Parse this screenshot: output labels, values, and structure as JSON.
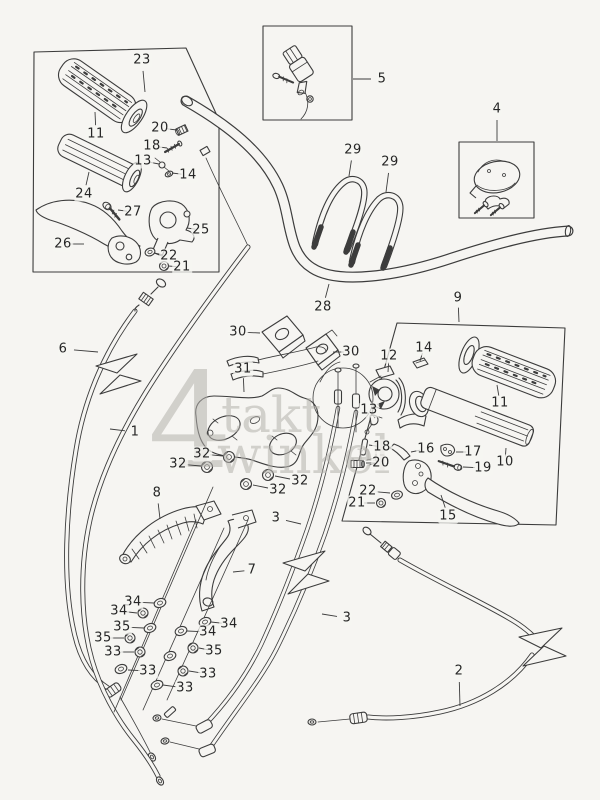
{
  "figure": {
    "background": "#f6f5f2",
    "line_color": "#3c3c3c",
    "label_color": "#262626"
  },
  "watermark": {
    "big": "4",
    "word1": "takt",
    "word2": "winkel",
    "suffix": ".nl",
    "color": "#b4b2ad"
  },
  "callouts": [
    {
      "label": "23",
      "x": 142,
      "y": 60,
      "tx": 145,
      "ty": 92
    },
    {
      "label": "11",
      "x": 96,
      "y": 134,
      "tx": 95,
      "ty": 112
    },
    {
      "label": "20",
      "x": 160,
      "y": 128,
      "tx": 177,
      "ty": 130
    },
    {
      "label": "18",
      "x": 152,
      "y": 146,
      "tx": 167,
      "ty": 148
    },
    {
      "label": "13",
      "x": 143,
      "y": 161,
      "tx": 159,
      "ty": 164
    },
    {
      "label": "14",
      "x": 188,
      "y": 175,
      "tx": 172,
      "ty": 173
    },
    {
      "label": "24",
      "x": 84,
      "y": 194,
      "tx": 89,
      "ty": 172
    },
    {
      "label": "27",
      "x": 133,
      "y": 212,
      "tx": 118,
      "ty": 210
    },
    {
      "label": "26",
      "x": 63,
      "y": 244,
      "tx": 84,
      "ty": 244
    },
    {
      "label": "25",
      "x": 201,
      "y": 230,
      "tx": 187,
      "ty": 228
    },
    {
      "label": "22",
      "x": 169,
      "y": 256,
      "tx": 154,
      "ty": 253
    },
    {
      "label": "21",
      "x": 182,
      "y": 267,
      "tx": 168,
      "ty": 266
    },
    {
      "label": "5",
      "x": 382,
      "y": 79,
      "tx": 353,
      "ty": 79
    },
    {
      "label": "4",
      "x": 497,
      "y": 109,
      "tx": 497,
      "ty": 141
    },
    {
      "label": "29",
      "x": 353,
      "y": 150,
      "tx": 349,
      "ty": 176
    },
    {
      "label": "29",
      "x": 390,
      "y": 162,
      "tx": 386,
      "ty": 192
    },
    {
      "label": "28",
      "x": 323,
      "y": 307,
      "tx": 329,
      "ty": 284
    },
    {
      "label": "9",
      "x": 458,
      "y": 298,
      "tx": 459,
      "ty": 322
    },
    {
      "label": "6",
      "x": 63,
      "y": 349,
      "tx": 98,
      "ty": 352
    },
    {
      "label": "1",
      "x": 135,
      "y": 432,
      "tx": 110,
      "ty": 429
    },
    {
      "label": "30",
      "x": 238,
      "y": 332,
      "tx": 260,
      "ty": 333
    },
    {
      "label": "30",
      "x": 351,
      "y": 352,
      "tx": 333,
      "ty": 352
    },
    {
      "label": "31",
      "x": 243,
      "y": 369,
      "tx": 244,
      "ty": 392
    },
    {
      "label": "12",
      "x": 389,
      "y": 356,
      "tx": 388,
      "ty": 372
    },
    {
      "label": "14",
      "x": 424,
      "y": 348,
      "tx": 420,
      "ty": 361
    },
    {
      "label": "13",
      "x": 369,
      "y": 410,
      "tx": 375,
      "ty": 418
    },
    {
      "label": "11",
      "x": 500,
      "y": 403,
      "tx": 497,
      "ty": 385
    },
    {
      "label": "10",
      "x": 505,
      "y": 462,
      "tx": 506,
      "ty": 448
    },
    {
      "label": "16",
      "x": 426,
      "y": 449,
      "tx": 411,
      "ty": 452
    },
    {
      "label": "17",
      "x": 473,
      "y": 452,
      "tx": 456,
      "ty": 452
    },
    {
      "label": "19",
      "x": 483,
      "y": 468,
      "tx": 463,
      "ty": 467
    },
    {
      "label": "18",
      "x": 382,
      "y": 447,
      "tx": 369,
      "ty": 445
    },
    {
      "label": "20",
      "x": 381,
      "y": 463,
      "tx": 366,
      "ty": 463
    },
    {
      "label": "22",
      "x": 368,
      "y": 491,
      "tx": 390,
      "ty": 493
    },
    {
      "label": "21",
      "x": 357,
      "y": 503,
      "tx": 375,
      "ty": 503
    },
    {
      "label": "15",
      "x": 448,
      "y": 516,
      "tx": 441,
      "ty": 495
    },
    {
      "label": "32",
      "x": 202,
      "y": 454,
      "tx": 223,
      "ty": 456
    },
    {
      "label": "32",
      "x": 178,
      "y": 464,
      "tx": 201,
      "ty": 466
    },
    {
      "label": "32",
      "x": 300,
      "y": 481,
      "tx": 275,
      "ty": 476
    },
    {
      "label": "32",
      "x": 278,
      "y": 490,
      "tx": 253,
      "ty": 485
    },
    {
      "label": "8",
      "x": 157,
      "y": 493,
      "tx": 160,
      "ty": 519
    },
    {
      "label": "7",
      "x": 252,
      "y": 570,
      "tx": 233,
      "ty": 572
    },
    {
      "label": "3",
      "x": 276,
      "y": 518,
      "tx": 301,
      "ty": 524
    },
    {
      "label": "3",
      "x": 347,
      "y": 618,
      "tx": 322,
      "ty": 614
    },
    {
      "label": "34",
      "x": 133,
      "y": 602,
      "tx": 154,
      "ty": 603
    },
    {
      "label": "34",
      "x": 119,
      "y": 611,
      "tx": 137,
      "ty": 613
    },
    {
      "label": "35",
      "x": 122,
      "y": 627,
      "tx": 144,
      "ty": 628
    },
    {
      "label": "35",
      "x": 103,
      "y": 638,
      "tx": 124,
      "ty": 638
    },
    {
      "label": "33",
      "x": 113,
      "y": 652,
      "tx": 134,
      "ty": 652
    },
    {
      "label": "33",
      "x": 148,
      "y": 671,
      "tx": 128,
      "ty": 670
    },
    {
      "label": "34",
      "x": 229,
      "y": 624,
      "tx": 211,
      "ty": 622
    },
    {
      "label": "34",
      "x": 208,
      "y": 632,
      "tx": 187,
      "ty": 631
    },
    {
      "label": "35",
      "x": 214,
      "y": 651,
      "tx": 199,
      "ty": 648
    },
    {
      "label": "33",
      "x": 208,
      "y": 674,
      "tx": 189,
      "ty": 671
    },
    {
      "label": "33",
      "x": 185,
      "y": 688,
      "tx": 163,
      "ty": 685
    },
    {
      "label": "2",
      "x": 459,
      "y": 671,
      "tx": 460,
      "ty": 706
    }
  ]
}
